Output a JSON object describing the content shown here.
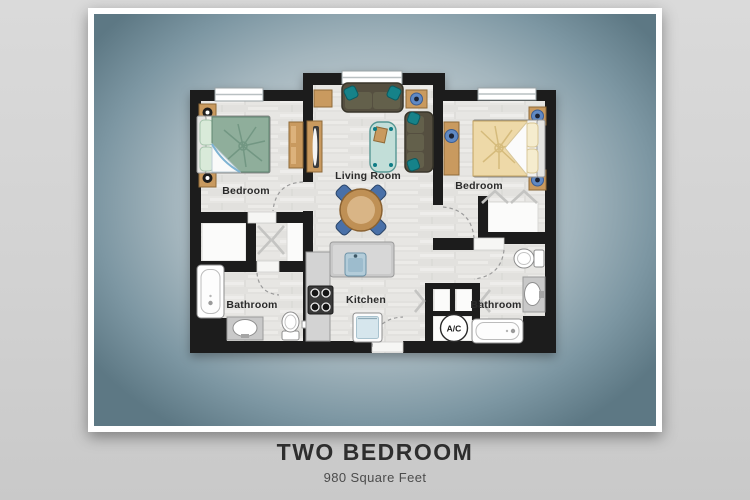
{
  "header": {
    "title": "TWO BEDROOM",
    "subtitle": "980 Square Feet"
  },
  "floorplan": {
    "rooms": [
      {
        "id": "bedroom-left",
        "label": "Bedroom"
      },
      {
        "id": "living-room",
        "label": "Living Room"
      },
      {
        "id": "bedroom-right",
        "label": "Bedroom"
      },
      {
        "id": "bathroom-left",
        "label": "Bathroom"
      },
      {
        "id": "kitchen",
        "label": "Kitchen"
      },
      {
        "id": "bathroom-right",
        "label": "Bathroom"
      },
      {
        "id": "ac-closet",
        "label": "A/C"
      }
    ]
  },
  "colors": {
    "page_background": "#d2d2d2",
    "card_frame": "#ffffff",
    "card_gradient_center": "#d4dcdf",
    "card_gradient_edge": "#5d7884",
    "wall": "#1f1f1f",
    "floor": "#e6e5e2",
    "closet_white": "#fbfbfa",
    "accent_tan": "#c99a5f",
    "accent_teal": "#128289",
    "accent_blue": "#4a70a8",
    "blanket_green": "#8fae9b",
    "blanket_tan": "#eed9a8",
    "counter_gray": "#cccccc",
    "title_color": "#2e2e2e"
  }
}
